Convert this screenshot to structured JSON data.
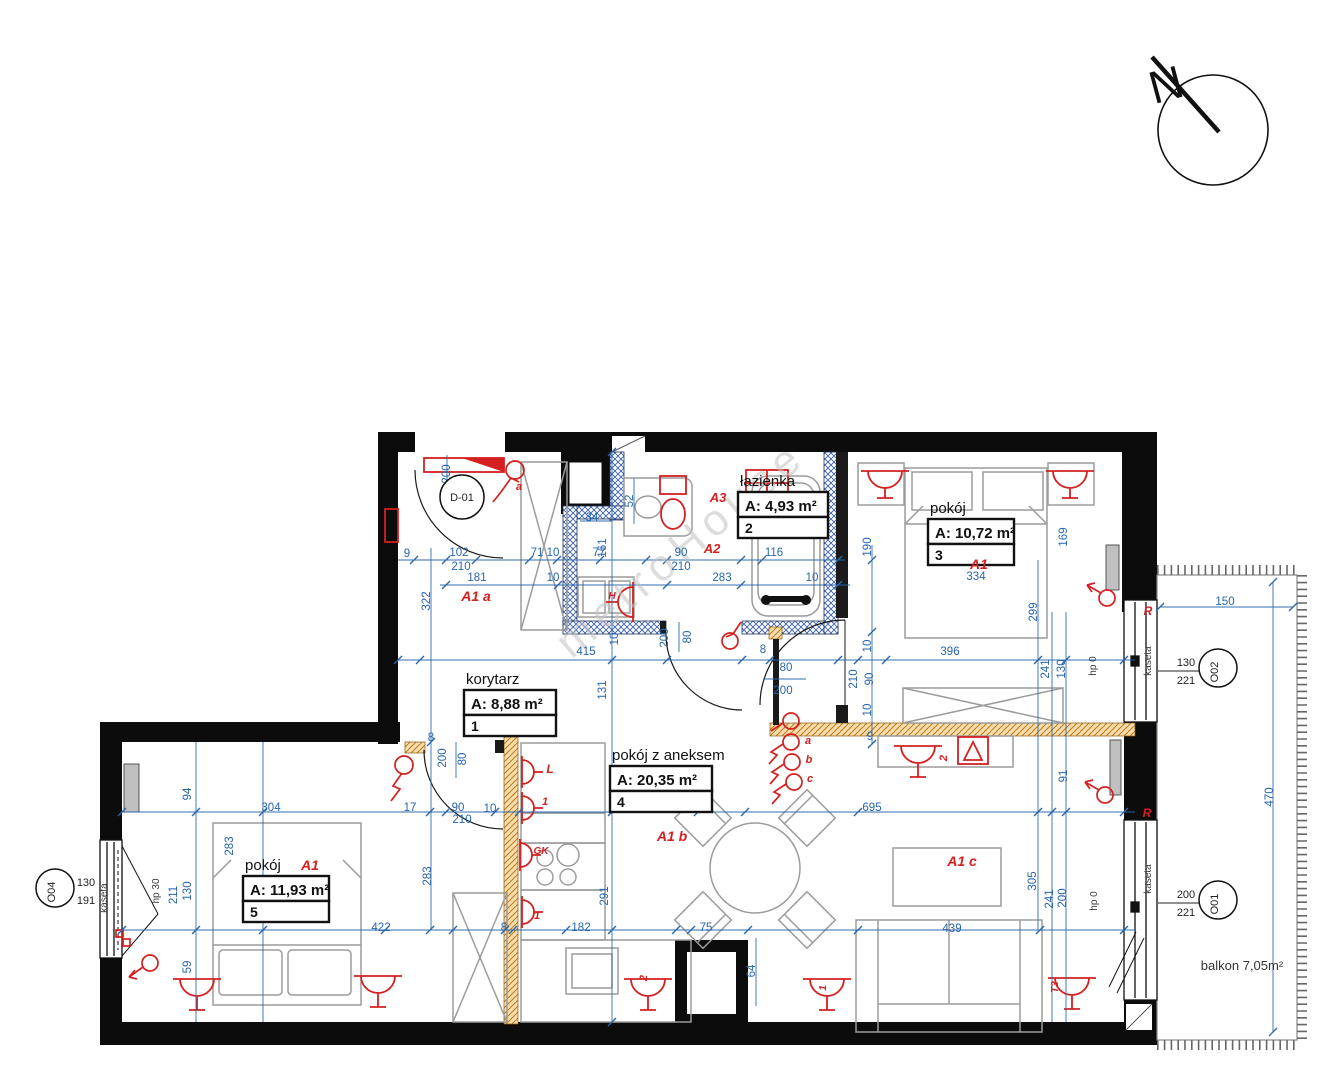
{
  "compass": {
    "label": "N"
  },
  "watermark": "metroHouse",
  "balcony": {
    "label": "balkon 7,05m²",
    "x": 1242,
    "y": 970
  },
  "rooms": [
    {
      "name": "korytarz",
      "area": "A: 8,88 m²",
      "number": "1",
      "x": 464,
      "y": 672,
      "w": 92
    },
    {
      "name": "łazienka",
      "area": "A: 4,93 m²",
      "number": "2",
      "x": 738,
      "y": 474,
      "w": 90
    },
    {
      "name": "pokój",
      "area": "A: 10,72 m²",
      "number": "3",
      "x": 928,
      "y": 501,
      "w": 86
    },
    {
      "name": "pokój z aneksem",
      "area": "A: 20,35 m²",
      "number": "4",
      "x": 610,
      "y": 748,
      "w": 102
    },
    {
      "name": "pokój",
      "area": "A: 11,93 m²",
      "number": "5",
      "x": 243,
      "y": 858,
      "w": 86
    }
  ],
  "markers": [
    {
      "id": "D-01",
      "x": 462,
      "y": 497,
      "r": 22,
      "vert": false
    },
    {
      "id": "O02",
      "x": 1218,
      "y": 668,
      "r": 19,
      "vert": true,
      "top": "130",
      "bottom": "221",
      "tx": 1186,
      "ty": 668,
      "leader": [
        1158,
        1199
      ]
    },
    {
      "id": "O01",
      "x": 1218,
      "y": 900,
      "r": 19,
      "vert": true,
      "top": "200",
      "bottom": "221",
      "tx": 1186,
      "ty": 900,
      "leader": [
        1158,
        1199
      ]
    },
    {
      "id": "O04",
      "x": 55,
      "y": 888,
      "r": 19,
      "vert": true,
      "top": "130",
      "bottom": "191",
      "tx": 86,
      "ty": 888,
      "leader": [
        74,
        102
      ]
    }
  ],
  "dims": [
    {
      "t": "200",
      "x": 450,
      "y": 474,
      "r": -90
    },
    {
      "t": "9",
      "x": 407,
      "y": 557
    },
    {
      "t": "102",
      "x": 459,
      "y": 556
    },
    {
      "t": "210",
      "x": 461,
      "y": 570
    },
    {
      "t": "71 10",
      "x": 545,
      "y": 556
    },
    {
      "t": "77",
      "x": 599,
      "y": 556
    },
    {
      "t": "90",
      "x": 681,
      "y": 556
    },
    {
      "t": "210",
      "x": 681,
      "y": 570
    },
    {
      "t": "116",
      "x": 774,
      "y": 556
    },
    {
      "t": "181",
      "x": 477,
      "y": 581
    },
    {
      "t": "10",
      "x": 553,
      "y": 581
    },
    {
      "t": "283",
      "x": 722,
      "y": 581
    },
    {
      "t": "10",
      "x": 812,
      "y": 581
    },
    {
      "t": "34",
      "x": 592,
      "y": 521
    },
    {
      "t": "52",
      "x": 633,
      "y": 501,
      "r": -90
    },
    {
      "t": "161",
      "x": 606,
      "y": 548,
      "r": -90
    },
    {
      "t": "322",
      "x": 430,
      "y": 601,
      "r": -90
    },
    {
      "t": "190",
      "x": 871,
      "y": 547,
      "r": -90
    },
    {
      "t": "169",
      "x": 1067,
      "y": 537,
      "r": -90
    },
    {
      "t": "334",
      "x": 976,
      "y": 580
    },
    {
      "t": "299",
      "x": 1037,
      "y": 612,
      "r": -90
    },
    {
      "t": "415",
      "x": 586,
      "y": 655
    },
    {
      "t": "396",
      "x": 950,
      "y": 655
    },
    {
      "t": "131",
      "x": 606,
      "y": 690,
      "r": -90
    },
    {
      "t": "10",
      "x": 618,
      "y": 639,
      "r": -90
    },
    {
      "t": "200",
      "x": 668,
      "y": 638,
      "r": -90
    },
    {
      "t": "80",
      "x": 691,
      "y": 637,
      "r": -90
    },
    {
      "t": "8",
      "x": 763,
      "y": 653
    },
    {
      "t": "80",
      "x": 786,
      "y": 671
    },
    {
      "t": "200",
      "x": 783,
      "y": 694
    },
    {
      "t": "210",
      "x": 857,
      "y": 679,
      "r": -90
    },
    {
      "t": "90",
      "x": 873,
      "y": 679,
      "r": -90
    },
    {
      "t": "10",
      "x": 871,
      "y": 646,
      "r": -90
    },
    {
      "t": "10",
      "x": 871,
      "y": 710,
      "r": -90
    },
    {
      "t": "9",
      "x": 870,
      "y": 740
    },
    {
      "t": "241",
      "x": 1049,
      "y": 669,
      "r": -90
    },
    {
      "t": "130",
      "x": 1065,
      "y": 669,
      "r": -90
    },
    {
      "t": "150",
      "x": 1225,
      "y": 605
    },
    {
      "t": "470",
      "x": 1273,
      "y": 797,
      "r": -90
    },
    {
      "t": "695",
      "x": 872,
      "y": 811
    },
    {
      "t": "91",
      "x": 1067,
      "y": 776,
      "r": -90
    },
    {
      "t": "305",
      "x": 1036,
      "y": 881,
      "r": -90
    },
    {
      "t": "241",
      "x": 1053,
      "y": 899,
      "r": -90
    },
    {
      "t": "200",
      "x": 1066,
      "y": 898,
      "r": -90
    },
    {
      "t": "94",
      "x": 191,
      "y": 794,
      "r": -90
    },
    {
      "t": "304",
      "x": 271,
      "y": 811
    },
    {
      "t": "17",
      "x": 410,
      "y": 811
    },
    {
      "t": "283",
      "x": 233,
      "y": 846,
      "r": -90
    },
    {
      "t": "283",
      "x": 431,
      "y": 876,
      "r": -90
    },
    {
      "t": "211",
      "x": 177,
      "y": 895,
      "r": -90
    },
    {
      "t": "130",
      "x": 191,
      "y": 891,
      "r": -90
    },
    {
      "t": "90",
      "x": 458,
      "y": 811
    },
    {
      "t": "210",
      "x": 462,
      "y": 823
    },
    {
      "t": "10",
      "x": 490,
      "y": 812
    },
    {
      "t": "80",
      "x": 466,
      "y": 759,
      "r": -90
    },
    {
      "t": "200",
      "x": 446,
      "y": 758,
      "r": -90
    },
    {
      "t": "8",
      "x": 431,
      "y": 741
    },
    {
      "t": "422",
      "x": 381,
      "y": 931
    },
    {
      "t": "59",
      "x": 191,
      "y": 967,
      "r": -90
    },
    {
      "t": "8",
      "x": 504,
      "y": 931
    },
    {
      "t": "182",
      "x": 581,
      "y": 931
    },
    {
      "t": "291",
      "x": 608,
      "y": 896,
      "r": -90
    },
    {
      "t": "75",
      "x": 706,
      "y": 931
    },
    {
      "t": "64",
      "x": 755,
      "y": 971,
      "r": -90
    },
    {
      "t": "439",
      "x": 952,
      "y": 932
    }
  ],
  "annotations": [
    {
      "t": "kaseta",
      "x": 1151,
      "y": 661,
      "r": -90
    },
    {
      "t": "hp 0",
      "x": 1096,
      "y": 666,
      "r": -90
    },
    {
      "t": "kaseta",
      "x": 1151,
      "y": 879,
      "r": -90
    },
    {
      "t": "hp 0",
      "x": 1097,
      "y": 901,
      "r": -90
    },
    {
      "t": "kaseta",
      "x": 107,
      "y": 898,
      "r": -90
    },
    {
      "t": "hp 30",
      "x": 159,
      "y": 891,
      "r": -90
    }
  ],
  "red_labels": [
    {
      "t": "A1 a",
      "x": 476,
      "y": 601,
      "s": 14
    },
    {
      "t": "A3",
      "x": 718,
      "y": 502,
      "s": 13
    },
    {
      "t": "A2",
      "x": 712,
      "y": 553,
      "s": 13
    },
    {
      "t": "A1",
      "x": 979,
      "y": 569,
      "s": 14
    },
    {
      "t": "A1 b",
      "x": 672,
      "y": 841,
      "s": 14
    },
    {
      "t": "A1 c",
      "x": 962,
      "y": 866,
      "s": 14
    },
    {
      "t": "A1",
      "x": 310,
      "y": 870,
      "s": 14
    },
    {
      "t": "a",
      "x": 519,
      "y": 490,
      "s": 11
    },
    {
      "t": "a",
      "x": 808,
      "y": 744,
      "s": 11
    },
    {
      "t": "b",
      "x": 809,
      "y": 763,
      "s": 11
    },
    {
      "t": "c",
      "x": 810,
      "y": 782,
      "s": 11
    },
    {
      "t": "R",
      "x": 1148,
      "y": 615,
      "s": 12
    },
    {
      "t": "R",
      "x": 1147,
      "y": 817,
      "s": 12
    },
    {
      "t": "2",
      "x": 947,
      "y": 758,
      "s": 11,
      "r": -90
    },
    {
      "t": "L",
      "x": 550,
      "y": 773,
      "s": 12
    },
    {
      "t": "1",
      "x": 545,
      "y": 805,
      "s": 11
    },
    {
      "t": "GK",
      "x": 541,
      "y": 854,
      "s": 10
    },
    {
      "t": "1",
      "x": 537,
      "y": 919,
      "s": 11
    },
    {
      "t": "2",
      "x": 647,
      "y": 978,
      "s": 11,
      "r": -90
    },
    {
      "t": "H",
      "x": 612,
      "y": 599,
      "s": 10
    },
    {
      "t": "1",
      "x": 826,
      "y": 988,
      "s": 10,
      "r": -90
    },
    {
      "t": "T3",
      "x": 1058,
      "y": 987,
      "s": 10,
      "r": -90
    }
  ]
}
